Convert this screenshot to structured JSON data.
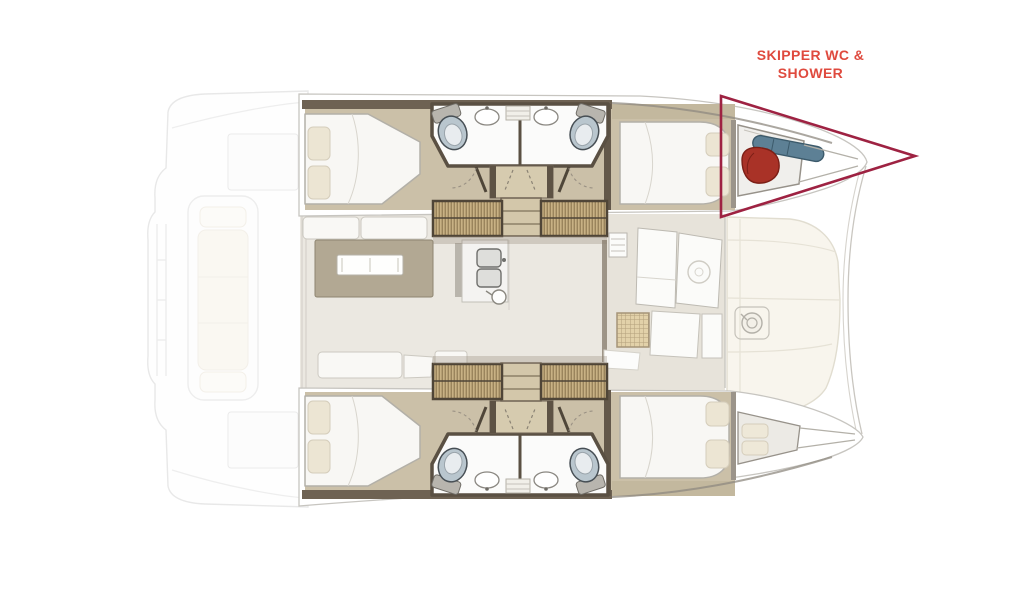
{
  "diagram": {
    "subject": "catamaran floor plan",
    "view": "top-down"
  },
  "annotation": {
    "line1": "SKIPPER WC &",
    "line2": "SHOWER",
    "text_color": "#df4a3e",
    "arrow_color": "#9e2242"
  },
  "palette": {
    "wood_floor": "#cbc0a8",
    "wall_brown": "#5d5244",
    "wardrobe_tan": "#c8b184",
    "cushion_cream": "#f6f2e6",
    "toilet_blue_gray": "#b9c6ce",
    "skipper_bag_red": "#a93227",
    "skipper_gear_blue": "#5d8095"
  }
}
